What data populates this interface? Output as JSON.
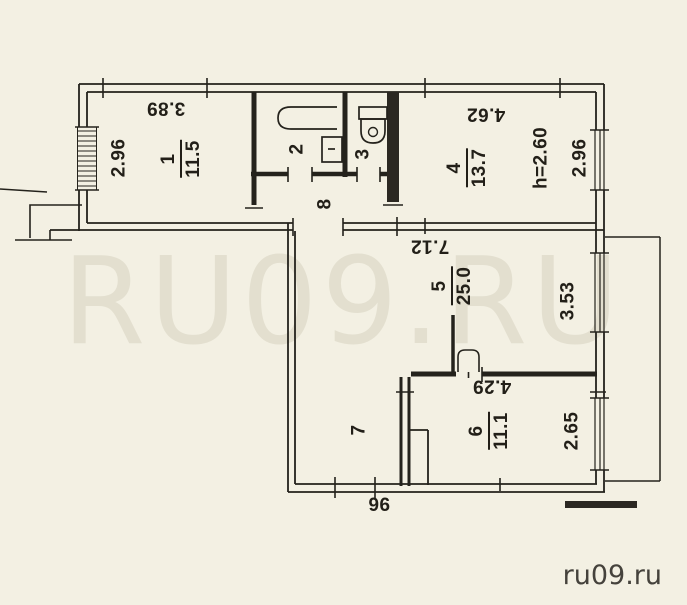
{
  "watermark": "RU09.RU",
  "site": "ru09.ru",
  "ceiling_height_note": "h=2.60",
  "labels": [
    {
      "name": "dim-width-room1",
      "text": "3.89"
    },
    {
      "name": "dim-depth-room1",
      "text": "2.96"
    },
    {
      "name": "room-2-number",
      "text": "2"
    },
    {
      "name": "room-3-number",
      "text": "3"
    },
    {
      "name": "room-8-number",
      "text": "8"
    },
    {
      "name": "dim-width-room4",
      "text": "4.62"
    },
    {
      "name": "ceiling-height",
      "text": "h=2.60"
    },
    {
      "name": "dim-depth-room4",
      "text": "2.96"
    },
    {
      "name": "dim-width-room5",
      "text": "7.12"
    },
    {
      "name": "dim-depth-room5",
      "text": "3.53"
    },
    {
      "name": "dim-width-room6",
      "text": "4.29"
    },
    {
      "name": "dim-depth-room6",
      "text": "2.65"
    },
    {
      "name": "room-7-number",
      "text": "7"
    },
    {
      "name": "dim-door",
      "text": "96"
    }
  ],
  "fractions": [
    {
      "name": "room-1",
      "number": "1",
      "area": "11.5"
    },
    {
      "name": "room-4",
      "number": "4",
      "area": "13.7"
    },
    {
      "name": "room-5",
      "number": "5",
      "area": "25.0"
    },
    {
      "name": "room-6",
      "number": "6",
      "area": "11.1"
    }
  ]
}
